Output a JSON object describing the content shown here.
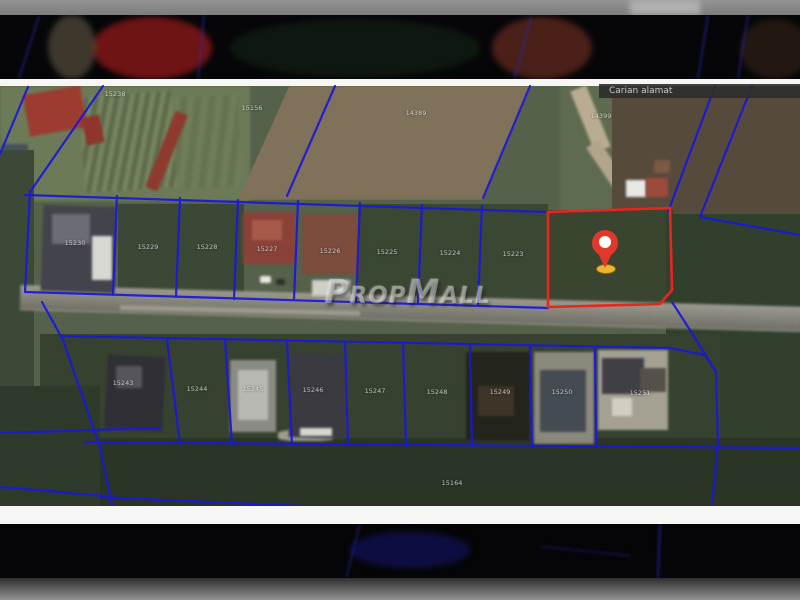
{
  "photo": {
    "search_overlay": {
      "label": "Carian alamat"
    },
    "watermark": {
      "text": "PropMall"
    },
    "selected_lot": {
      "marker": "map-pin",
      "outline_color": "#e8251f"
    },
    "colors": {
      "cadastral_line": "#1a18da",
      "selected_outline": "#e8251f",
      "pin": "#e2372b",
      "pin_base": "#f0b52c",
      "letterbox_white": "#f7f7f5"
    },
    "lot_labels": [
      {
        "text": "15238",
        "x": 115,
        "y": 94
      },
      {
        "text": "15156",
        "x": 252,
        "y": 108
      },
      {
        "text": "14389",
        "x": 416,
        "y": 113
      },
      {
        "text": "14399",
        "x": 601,
        "y": 116
      },
      {
        "text": "15230",
        "x": 75,
        "y": 243
      },
      {
        "text": "15229",
        "x": 148,
        "y": 247
      },
      {
        "text": "15228",
        "x": 207,
        "y": 247
      },
      {
        "text": "15227",
        "x": 267,
        "y": 249
      },
      {
        "text": "15226",
        "x": 330,
        "y": 251
      },
      {
        "text": "15225",
        "x": 387,
        "y": 252
      },
      {
        "text": "15224",
        "x": 450,
        "y": 253
      },
      {
        "text": "15223",
        "x": 513,
        "y": 254
      },
      {
        "text": "15243",
        "x": 123,
        "y": 383
      },
      {
        "text": "15244",
        "x": 197,
        "y": 389
      },
      {
        "text": "15245",
        "x": 253,
        "y": 389
      },
      {
        "text": "15246",
        "x": 313,
        "y": 390
      },
      {
        "text": "15247",
        "x": 375,
        "y": 391
      },
      {
        "text": "15248",
        "x": 437,
        "y": 392
      },
      {
        "text": "15249",
        "x": 500,
        "y": 392
      },
      {
        "text": "15250",
        "x": 562,
        "y": 392
      },
      {
        "text": "15251",
        "x": 640,
        "y": 393
      },
      {
        "text": "15164",
        "x": 452,
        "y": 483
      }
    ]
  }
}
